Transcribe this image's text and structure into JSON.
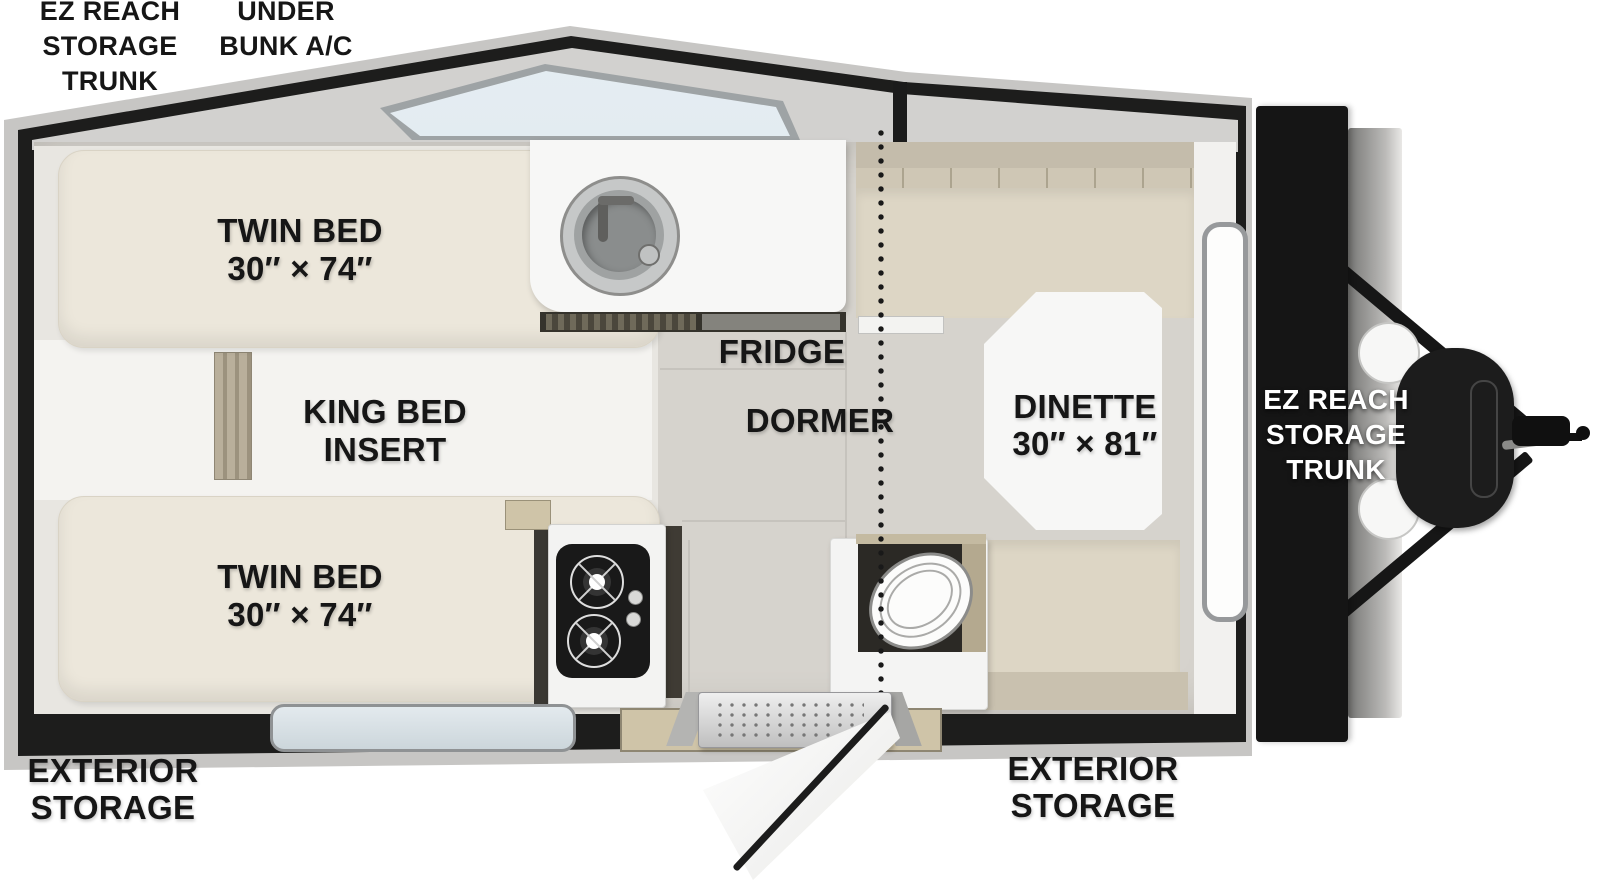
{
  "title": "Travel trailer floor plan (top view)",
  "colors": {
    "wall": "#1d1d1c",
    "rim": "#c7c6c4",
    "roof_deck": "#d2d1cf",
    "floor_tile": "#d6d3cd",
    "bedroom_floor": "#e8e6e1",
    "bed_cushion": "#ece7db",
    "bench_cushion": "#ddd6c5",
    "white_surface": "#f7f7f6",
    "skylight": "#dbe6ec",
    "wood": "#cfc4a8",
    "trunk_black": "#151515",
    "label_black": "#161616",
    "label_white": "#ffffff"
  },
  "labels": {
    "ez_reach_rear": {
      "lines": [
        "EZ REACH",
        "STORAGE",
        "TRUNK"
      ]
    },
    "under_bunk_ac": {
      "lines": [
        "UNDER",
        "BUNK A/C"
      ]
    },
    "twin_bed_top": {
      "lines": [
        "TWIN BED",
        "30″ × 74″"
      ]
    },
    "king_bed_insert": {
      "lines": [
        "KING BED",
        "INSERT"
      ]
    },
    "twin_bed_bottom": {
      "lines": [
        "TWIN BED",
        "30″ × 74″"
      ]
    },
    "fridge": "FRIDGE",
    "dormer": "DORMER",
    "dinette": {
      "lines": [
        "DINETTE",
        "30″ × 81″"
      ]
    },
    "ez_reach_front": {
      "lines": [
        "EZ REACH",
        "STORAGE",
        "TRUNK"
      ]
    },
    "exterior_storage_left": {
      "lines": [
        "EXTERIOR",
        "STORAGE"
      ]
    },
    "exterior_storage_right": {
      "lines": [
        "EXTERIOR",
        "STORAGE"
      ]
    }
  }
}
